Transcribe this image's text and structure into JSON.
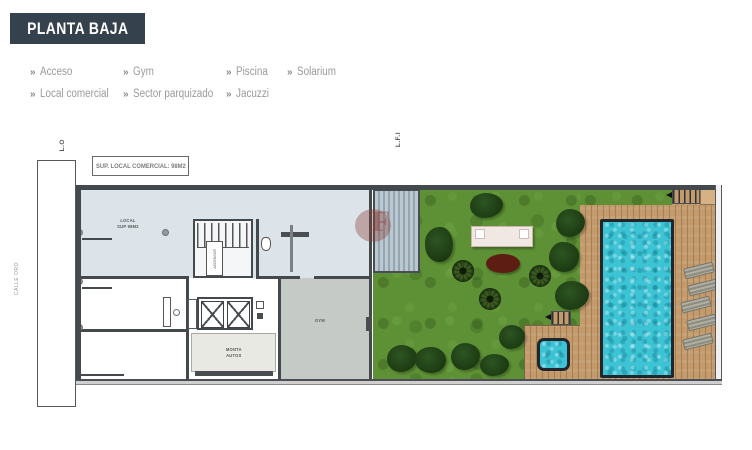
{
  "title": "PLANTA BAJA",
  "legend": {
    "marker": "»",
    "columns": [
      {
        "items": [
          {
            "label": "Acceso"
          },
          {
            "label": "Local comercial"
          }
        ]
      },
      {
        "items": [
          {
            "label": "Gym"
          },
          {
            "label": "Sector parquizado"
          }
        ]
      },
      {
        "items": [
          {
            "label": "Piscina"
          },
          {
            "label": "Jacuzzi"
          }
        ]
      },
      {
        "items": [
          {
            "label": "Solarium"
          }
        ]
      }
    ]
  },
  "plan": {
    "annotation": "SUP. LOCAL COMERCIAL: 98M2",
    "axis_labels": {
      "left": "L.O",
      "middle": "L.F.I"
    },
    "street": "CALLE ORO",
    "rooms": {
      "local_line1": "LOCAL",
      "local_line2": "SUP 98M2",
      "gym": "GYM",
      "car_lift_line1": "MONTA",
      "car_lift_line2": "AUTOS",
      "elevator": "ASCENSOR"
    }
  },
  "colors": {
    "title-bg": "#35414d",
    "title-text": "#ffffff",
    "legend-text": "#9a9a9a",
    "wall": "#43494d",
    "local-fill": "#dde4e9",
    "gym-fill": "#c5cac6",
    "room-fill": "#e9e9e4",
    "grass": "#5e9135",
    "deck": "#c39a6c",
    "deck-line": "#a67e52",
    "stripe-deck-a": "#bcc8d0",
    "stripe-deck-b": "#93a5b1",
    "water": "#3cc3d4",
    "pool-border": "#20262b",
    "lounger": "#b0afa2",
    "oval": "#5e1d13",
    "pergola": "#f1e8e4",
    "tan-box": "#d6b183",
    "watermark": "#8b4038"
  }
}
